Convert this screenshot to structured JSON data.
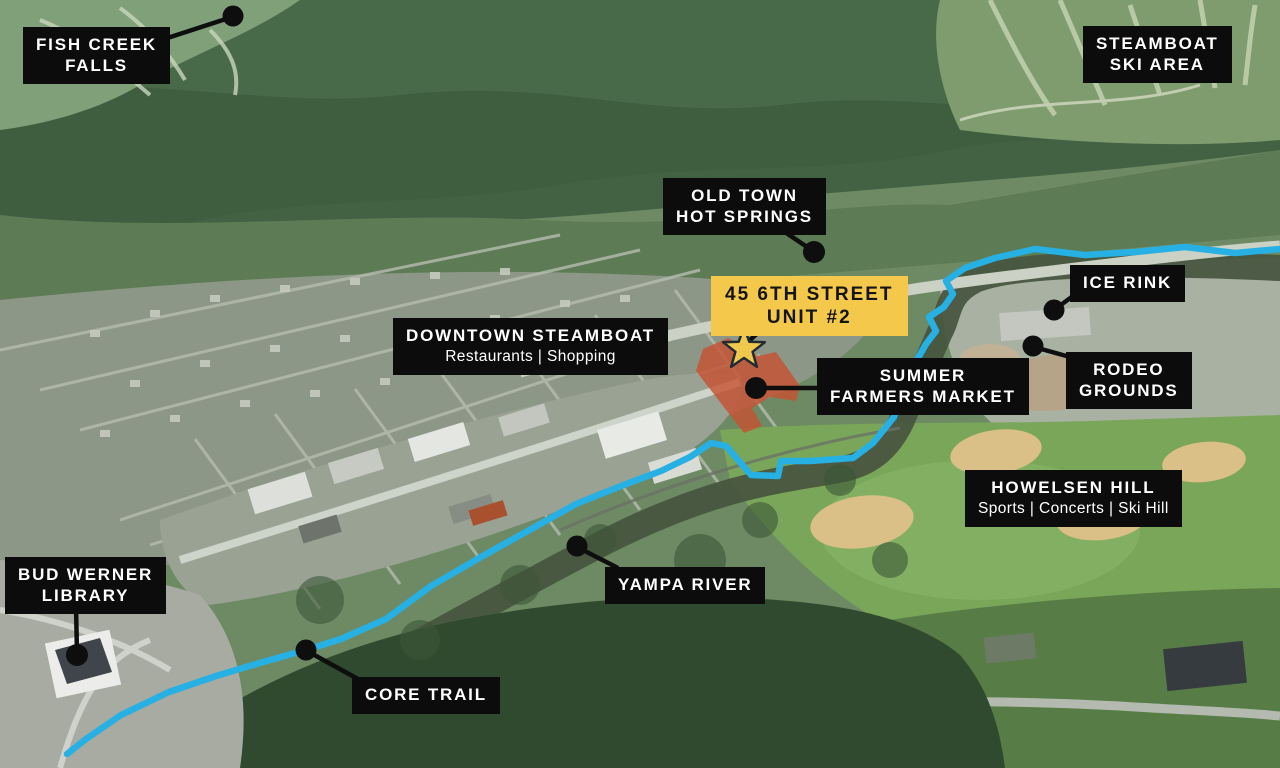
{
  "map": {
    "description": "Aerial location map of Steamboat Springs with points of interest",
    "labels": {
      "fish_creek_falls": {
        "line1": "FISH CREEK",
        "line2": "FALLS"
      },
      "steamboat_ski_area": {
        "line1": "STEAMBOAT",
        "line2": "SKI AREA"
      },
      "old_town_hot_springs": {
        "line1": "OLD TOWN",
        "line2": "HOT SPRINGS"
      },
      "property": {
        "line1": "45 6TH STREET",
        "line2": "UNIT #2"
      },
      "ice_rink": {
        "line1": "ICE RINK"
      },
      "downtown_steamboat": {
        "line1": "DOWNTOWN STEAMBOAT",
        "subtitle": "Restaurants | Shopping"
      },
      "summer_farmers_market": {
        "line1": "SUMMER",
        "line2": "FARMERS MARKET"
      },
      "rodeo_grounds": {
        "line1": "RODEO",
        "line2": "GROUNDS"
      },
      "howelsen_hill": {
        "line1": "HOWELSEN HILL",
        "subtitle": "Sports | Concerts | Ski Hill"
      },
      "yampa_river": {
        "line1": "YAMPA RIVER"
      },
      "bud_werner_library": {
        "line1": "BUD WERNER",
        "line2": "LIBRARY"
      },
      "core_trail": {
        "line1": "CORE TRAIL"
      }
    },
    "markers": {
      "property_star": "star-marker",
      "poi_dot": "black-dot-marker"
    },
    "colors": {
      "label_bg": "#0c0c0c",
      "label_text": "#ffffff",
      "property_bg": "#f3c84b",
      "property_text": "#141414",
      "trail": "#27b0e3",
      "star_fill": "#eec94e",
      "star_outline": "#222a33",
      "market_highlight": "#c7502f",
      "marker_black": "#0e0e0e"
    }
  }
}
